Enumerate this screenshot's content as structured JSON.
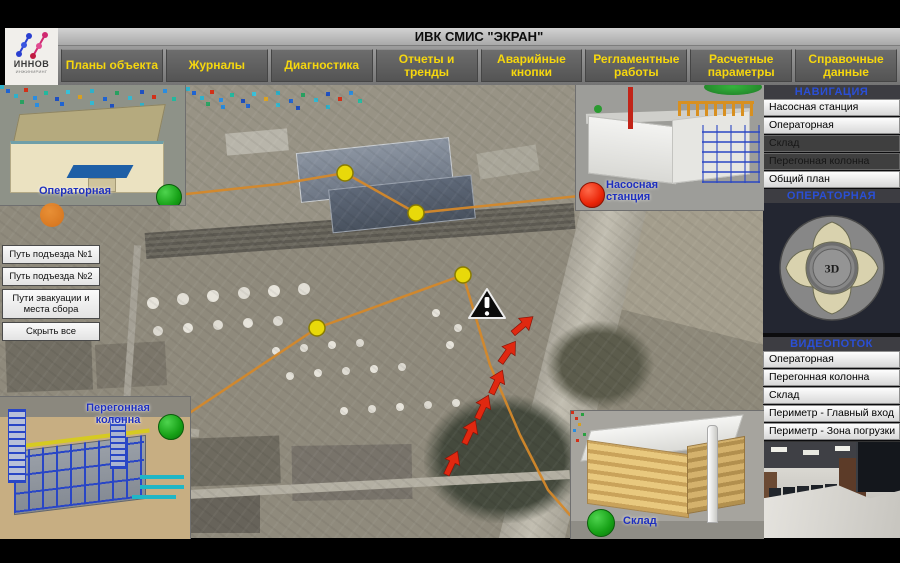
{
  "logo": {
    "title": "ИННОВ",
    "subtitle": "ИНЖИНИРИНГ"
  },
  "title_bar": {
    "title": "ИВК СМИС \"ЭКРАН\""
  },
  "menu": {
    "items": [
      {
        "label": "Планы объекта"
      },
      {
        "label": "Журналы"
      },
      {
        "label": "Диагностика"
      },
      {
        "label": "Отчеты и тренды"
      },
      {
        "label": "Аварийные кнопки"
      },
      {
        "label": "Регламентные работы"
      },
      {
        "label": "Расчетные параметры"
      },
      {
        "label": "Справочные данные"
      }
    ]
  },
  "navigation": {
    "header": "НАВИГАЦИЯ",
    "items": [
      {
        "label": "Насосная станция",
        "enabled": true
      },
      {
        "label": "Операторная",
        "enabled": true
      },
      {
        "label": "Склад",
        "enabled": false
      },
      {
        "label": "Перегонная колонна",
        "enabled": false
      },
      {
        "label": "Общий план",
        "enabled": true
      }
    ]
  },
  "camera": {
    "header": "ОПЕРАТОРНАЯ",
    "joystick_center": "3D"
  },
  "video": {
    "header": "ВИДЕОПОТОК",
    "items": [
      {
        "label": "Операторная"
      },
      {
        "label": "Перегонная колонна"
      },
      {
        "label": "Склад"
      },
      {
        "label": "Периметр - Главный вход"
      },
      {
        "label": "Периметр - Зона погрузки"
      }
    ]
  },
  "route_panel": {
    "items": [
      {
        "label": "Путь подъезда №1"
      },
      {
        "label": "Путь подъезда №2"
      },
      {
        "label": "Пути эвакуации и места сбора"
      },
      {
        "label": "Скрыть все"
      }
    ]
  },
  "map": {
    "labels": {
      "operator_room": "Операторная",
      "pump_station": "Насосная станция",
      "distillation_column": "Перегонная колонна",
      "warehouse": "Склад"
    },
    "markers": {
      "ok_color": "#1fa81f",
      "alarm_color": "#ea2508",
      "waypoint_color": "#e6d700",
      "route_color": "#d4882a",
      "evacuation_arrow_color": "#e02810",
      "pump_station_status": "alarm",
      "operator_room_status": "ok",
      "distillation_column_status": "ok",
      "warehouse_status": "ok"
    }
  }
}
